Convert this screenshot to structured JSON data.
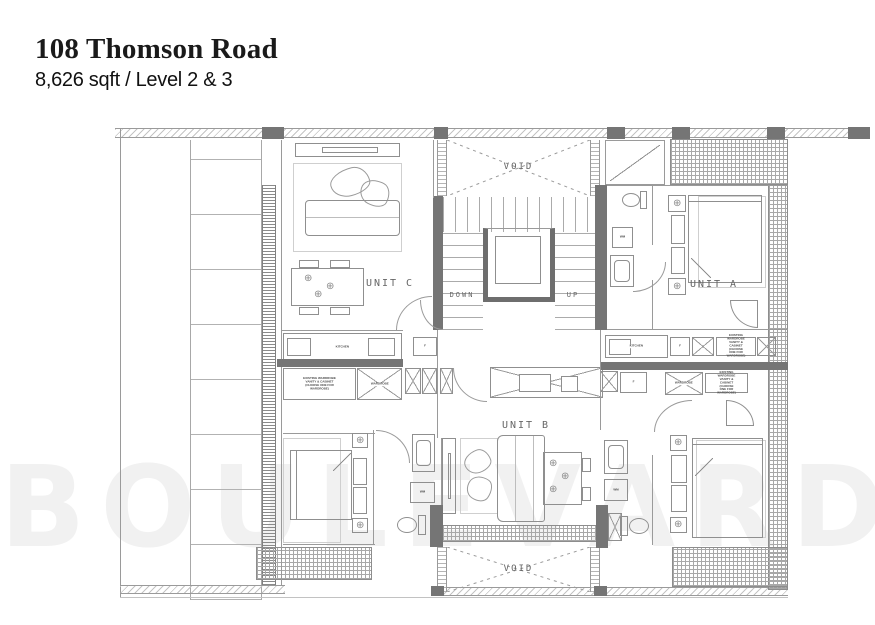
{
  "header": {
    "title": "108 Thomson Road",
    "subtitle": "8,626 sqft / Level 2 & 3"
  },
  "watermark": {
    "text": "BOULEVARD"
  },
  "plan": {
    "units": {
      "a": "UNIT A",
      "b": "UNIT B",
      "c": "UNIT C"
    },
    "voids": {
      "top": "VOID",
      "bottom": "VOID"
    },
    "stairs": {
      "down": "DOWN",
      "up": "UP"
    },
    "labels": {
      "kitchen": "KITCHEN",
      "fridge": "F",
      "wm": "WM",
      "wardrobe": "WARDROBE",
      "wardrobe_note": "EXISTING WARDROBE VANITY & CABINET (CHOOSE ONE FOR WARDROBE)"
    },
    "icons": {
      "fixture": "⊕"
    },
    "colors": {
      "line": "#9a9a9a",
      "wall": "#757575",
      "hatch": "#c4c4c4",
      "watermark": "#f1f1f1",
      "title": "#1a1a1a"
    }
  }
}
